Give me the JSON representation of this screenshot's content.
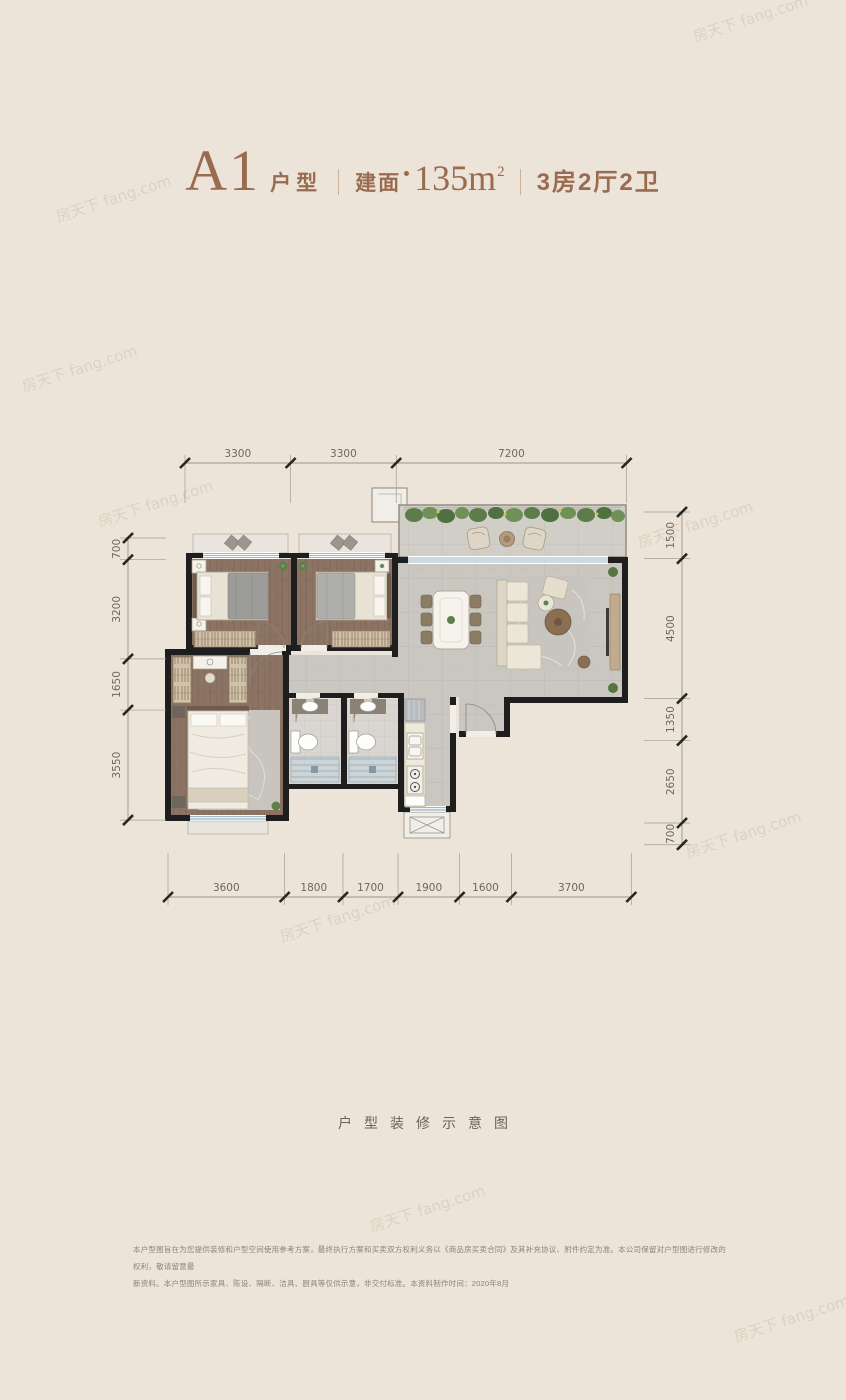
{
  "header": {
    "unit": "A1",
    "unit_suffix": "户型",
    "area_label": "建面",
    "area_value": "135m",
    "area_sup": "2",
    "rooms": "3房2厅2卫"
  },
  "dimensions": {
    "top": [
      3300,
      3300,
      7200
    ],
    "bottom": [
      3600,
      1800,
      1700,
      1900,
      1600,
      3700
    ],
    "left": [
      700,
      3200,
      1650,
      3550
    ],
    "right": [
      1500,
      4500,
      1350,
      2650,
      700
    ]
  },
  "caption": "户型装修示意图",
  "disclaimer": {
    "line1": "本户型图旨在为您提供装修和户型空间使用参考方案，最终执行方案和买卖双方权利义务以《商品房买卖合同》及其补充协议、附件约定为准。本公司保留对户型图进行修改的权利，敬请留意最",
    "line2": "新资料。本户型图所示家具、陈设、隔断、洁具、厨具等仅供示意，非交付标准。本资料制作时间：2020年8月"
  },
  "watermark": {
    "text": "房天下 fang.com"
  },
  "colors": {
    "background": "#ece4d8",
    "accent": "#9a6b50",
    "wall": "#1e1e1e",
    "window_blue": "#7fa0b5",
    "dimension_text": "#6e675d"
  }
}
